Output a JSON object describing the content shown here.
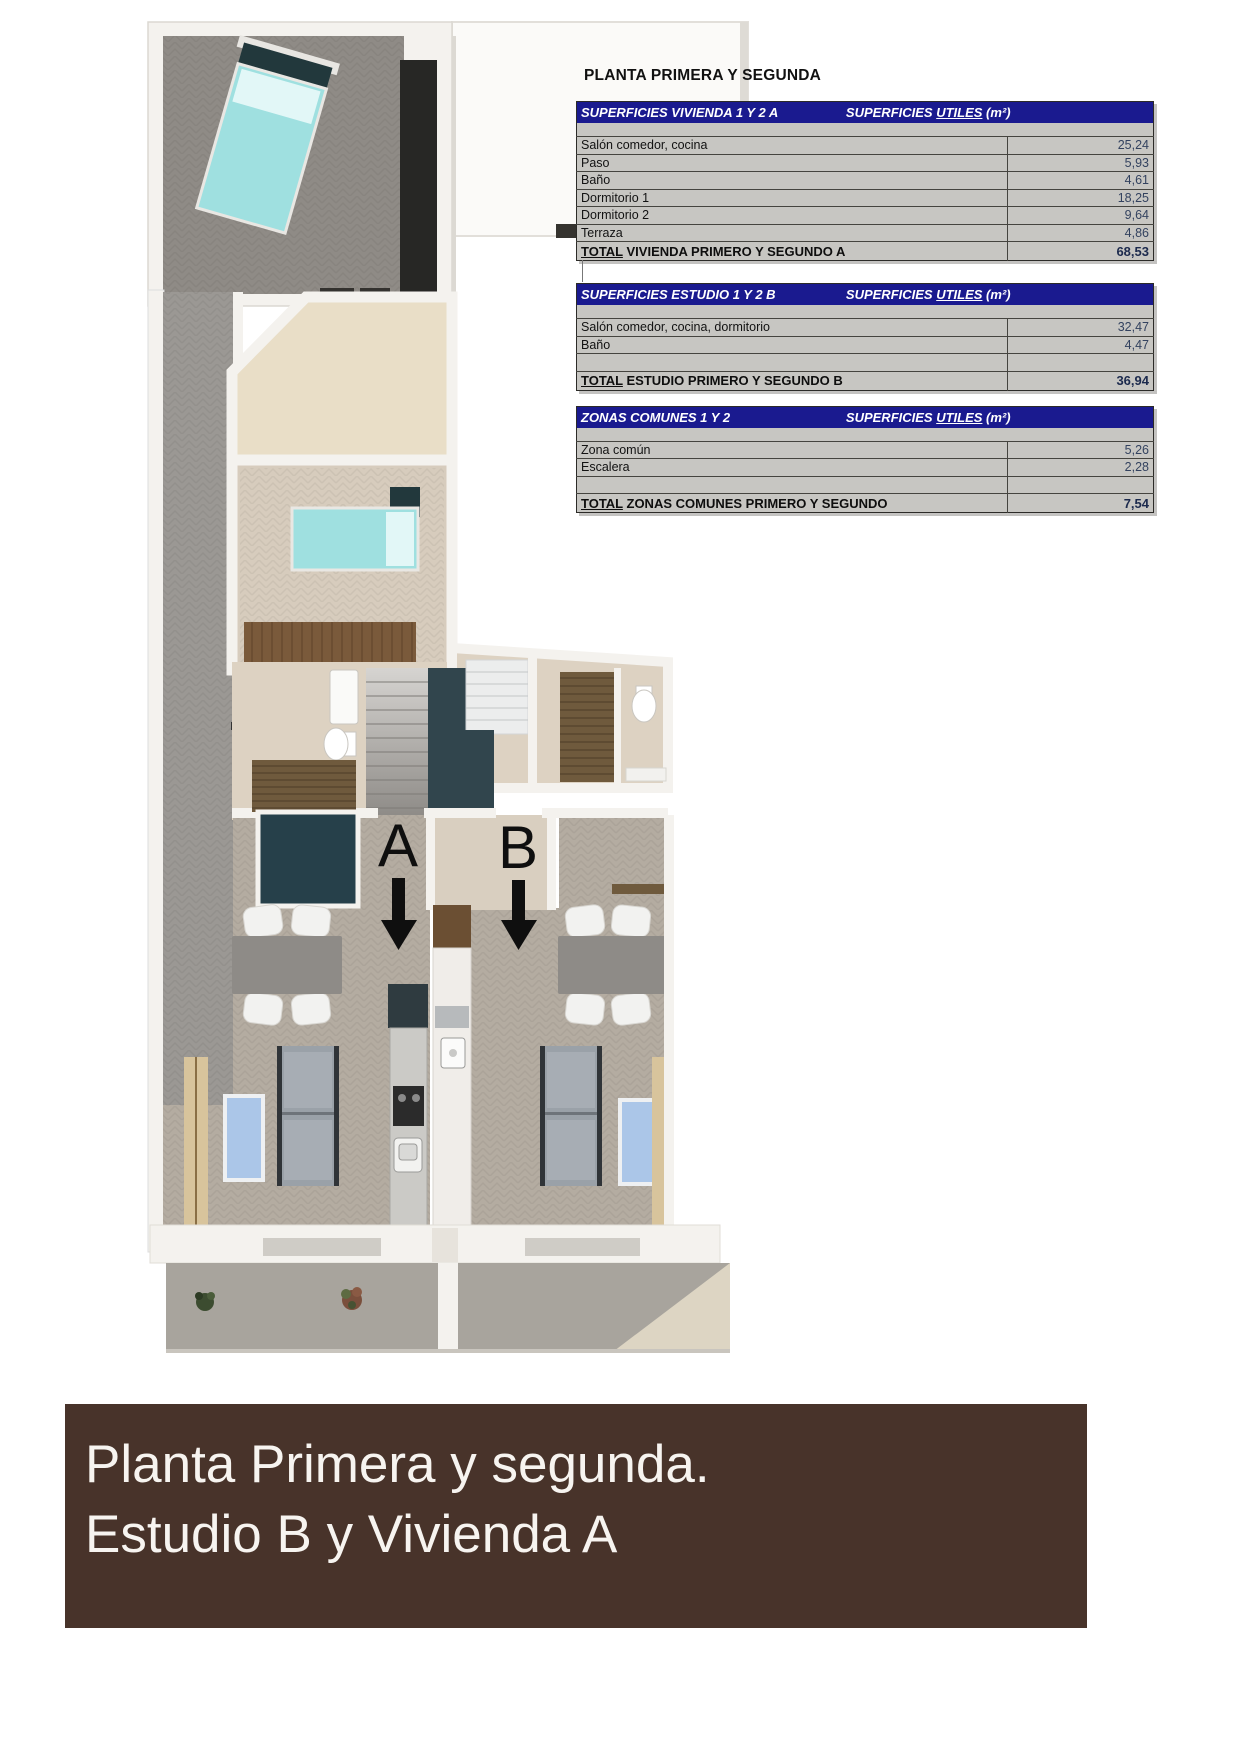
{
  "title": "PLANTA PRIMERA Y SEGUNDA",
  "tables": [
    {
      "header_left": "SUPERFICIES VIVIENDA 1 Y 2 A",
      "header_right_pre": "SUPERFICIES ",
      "header_right_u": "UTILES",
      "header_right_post": " (m²)",
      "rows": [
        {
          "label": "Salón comedor, cocina",
          "value": "25,24"
        },
        {
          "label": "Paso",
          "value": "5,93"
        },
        {
          "label": "Baño",
          "value": "4,61"
        },
        {
          "label": "Dormitorio 1",
          "value": "18,25"
        },
        {
          "label": "Dormitorio 2",
          "value": "9,64"
        },
        {
          "label": "Terraza",
          "value": "4,86"
        }
      ],
      "total_word": "TOTAL",
      "total_rest": " VIVIENDA PRIMERO Y SEGUNDO A",
      "total_value": "68,53"
    },
    {
      "header_left": "SUPERFICIES ESTUDIO 1 Y 2 B",
      "header_right_pre": "SUPERFICIES ",
      "header_right_u": "UTILES",
      "header_right_post": " (m²)",
      "rows": [
        {
          "label": "Salón comedor, cocina, dormitorio",
          "value": "32,47"
        },
        {
          "label": "Baño",
          "value": "4,47"
        }
      ],
      "total_word": "TOTAL",
      "total_rest": " ESTUDIO PRIMERO Y SEGUNDO B",
      "total_value": "36,94"
    },
    {
      "header_left": "ZONAS COMUNES 1 Y 2",
      "header_right_pre": "SUPERFICIES ",
      "header_right_u": "UTILES",
      "header_right_post": " (m²)",
      "rows": [
        {
          "label": "Zona común",
          "value": "5,26"
        },
        {
          "label": "Escalera",
          "value": "2,28"
        }
      ],
      "total_word": "TOTAL",
      "total_rest": " ZONAS COMUNES PRIMERO Y SEGUNDO",
      "total_value": "7,54"
    }
  ],
  "plan": {
    "marker_a": "A",
    "marker_b": "B"
  },
  "banner": {
    "line1": "Planta Primera y segunda.",
    "line2": "Estudio B y Vivienda A"
  },
  "colors": {
    "table_header_blue": "#1a1a8f",
    "table_body_grey": "#c7c6c2",
    "banner_brown": "#48332a",
    "bed_teal": "#9fe0e0",
    "rug_blue": "#abc6e8",
    "value_text": "#33425f"
  }
}
